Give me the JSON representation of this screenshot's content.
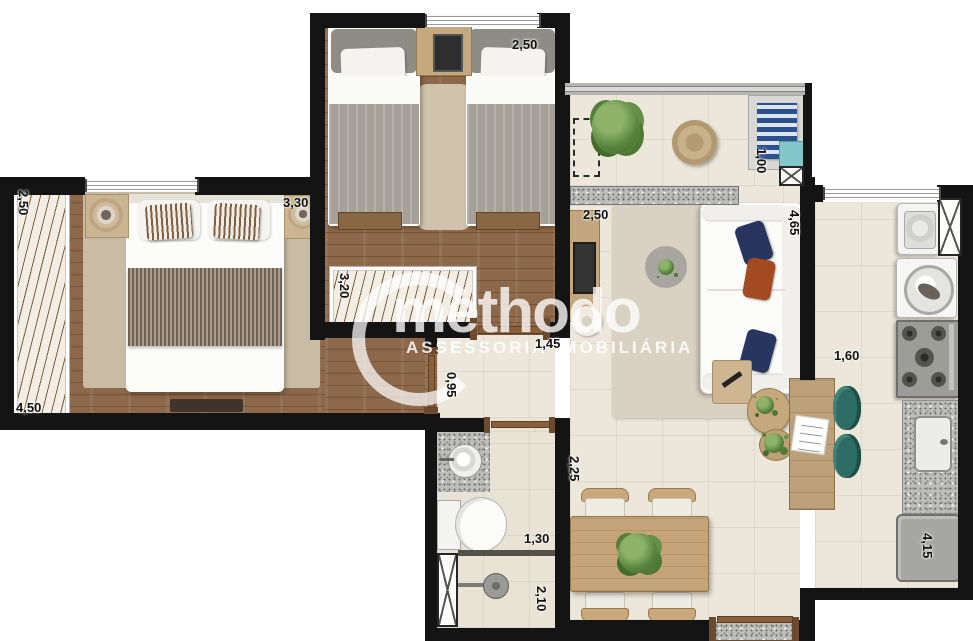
{
  "watermark": {
    "brand": "methodo",
    "subtitle": "ASSESSORIA IMOBILIÁRIA"
  },
  "dimensions": {
    "bedroom1_side": "2,50",
    "bedroom1_top": "3,30",
    "bedroom1_bottom": "4,50",
    "bedroom2_top": "2,50",
    "bedroom2_side": "3,20",
    "living_top": "2,50",
    "living_side": "4,65",
    "balcony_side": "1,00",
    "hall_width": "1,45",
    "hall_side": "0,95",
    "dining_side": "2,25",
    "bathroom_width": "1,30",
    "bathroom_side": "2,10",
    "kitchen_width": "1,60",
    "kitchen_side": "4,15"
  }
}
